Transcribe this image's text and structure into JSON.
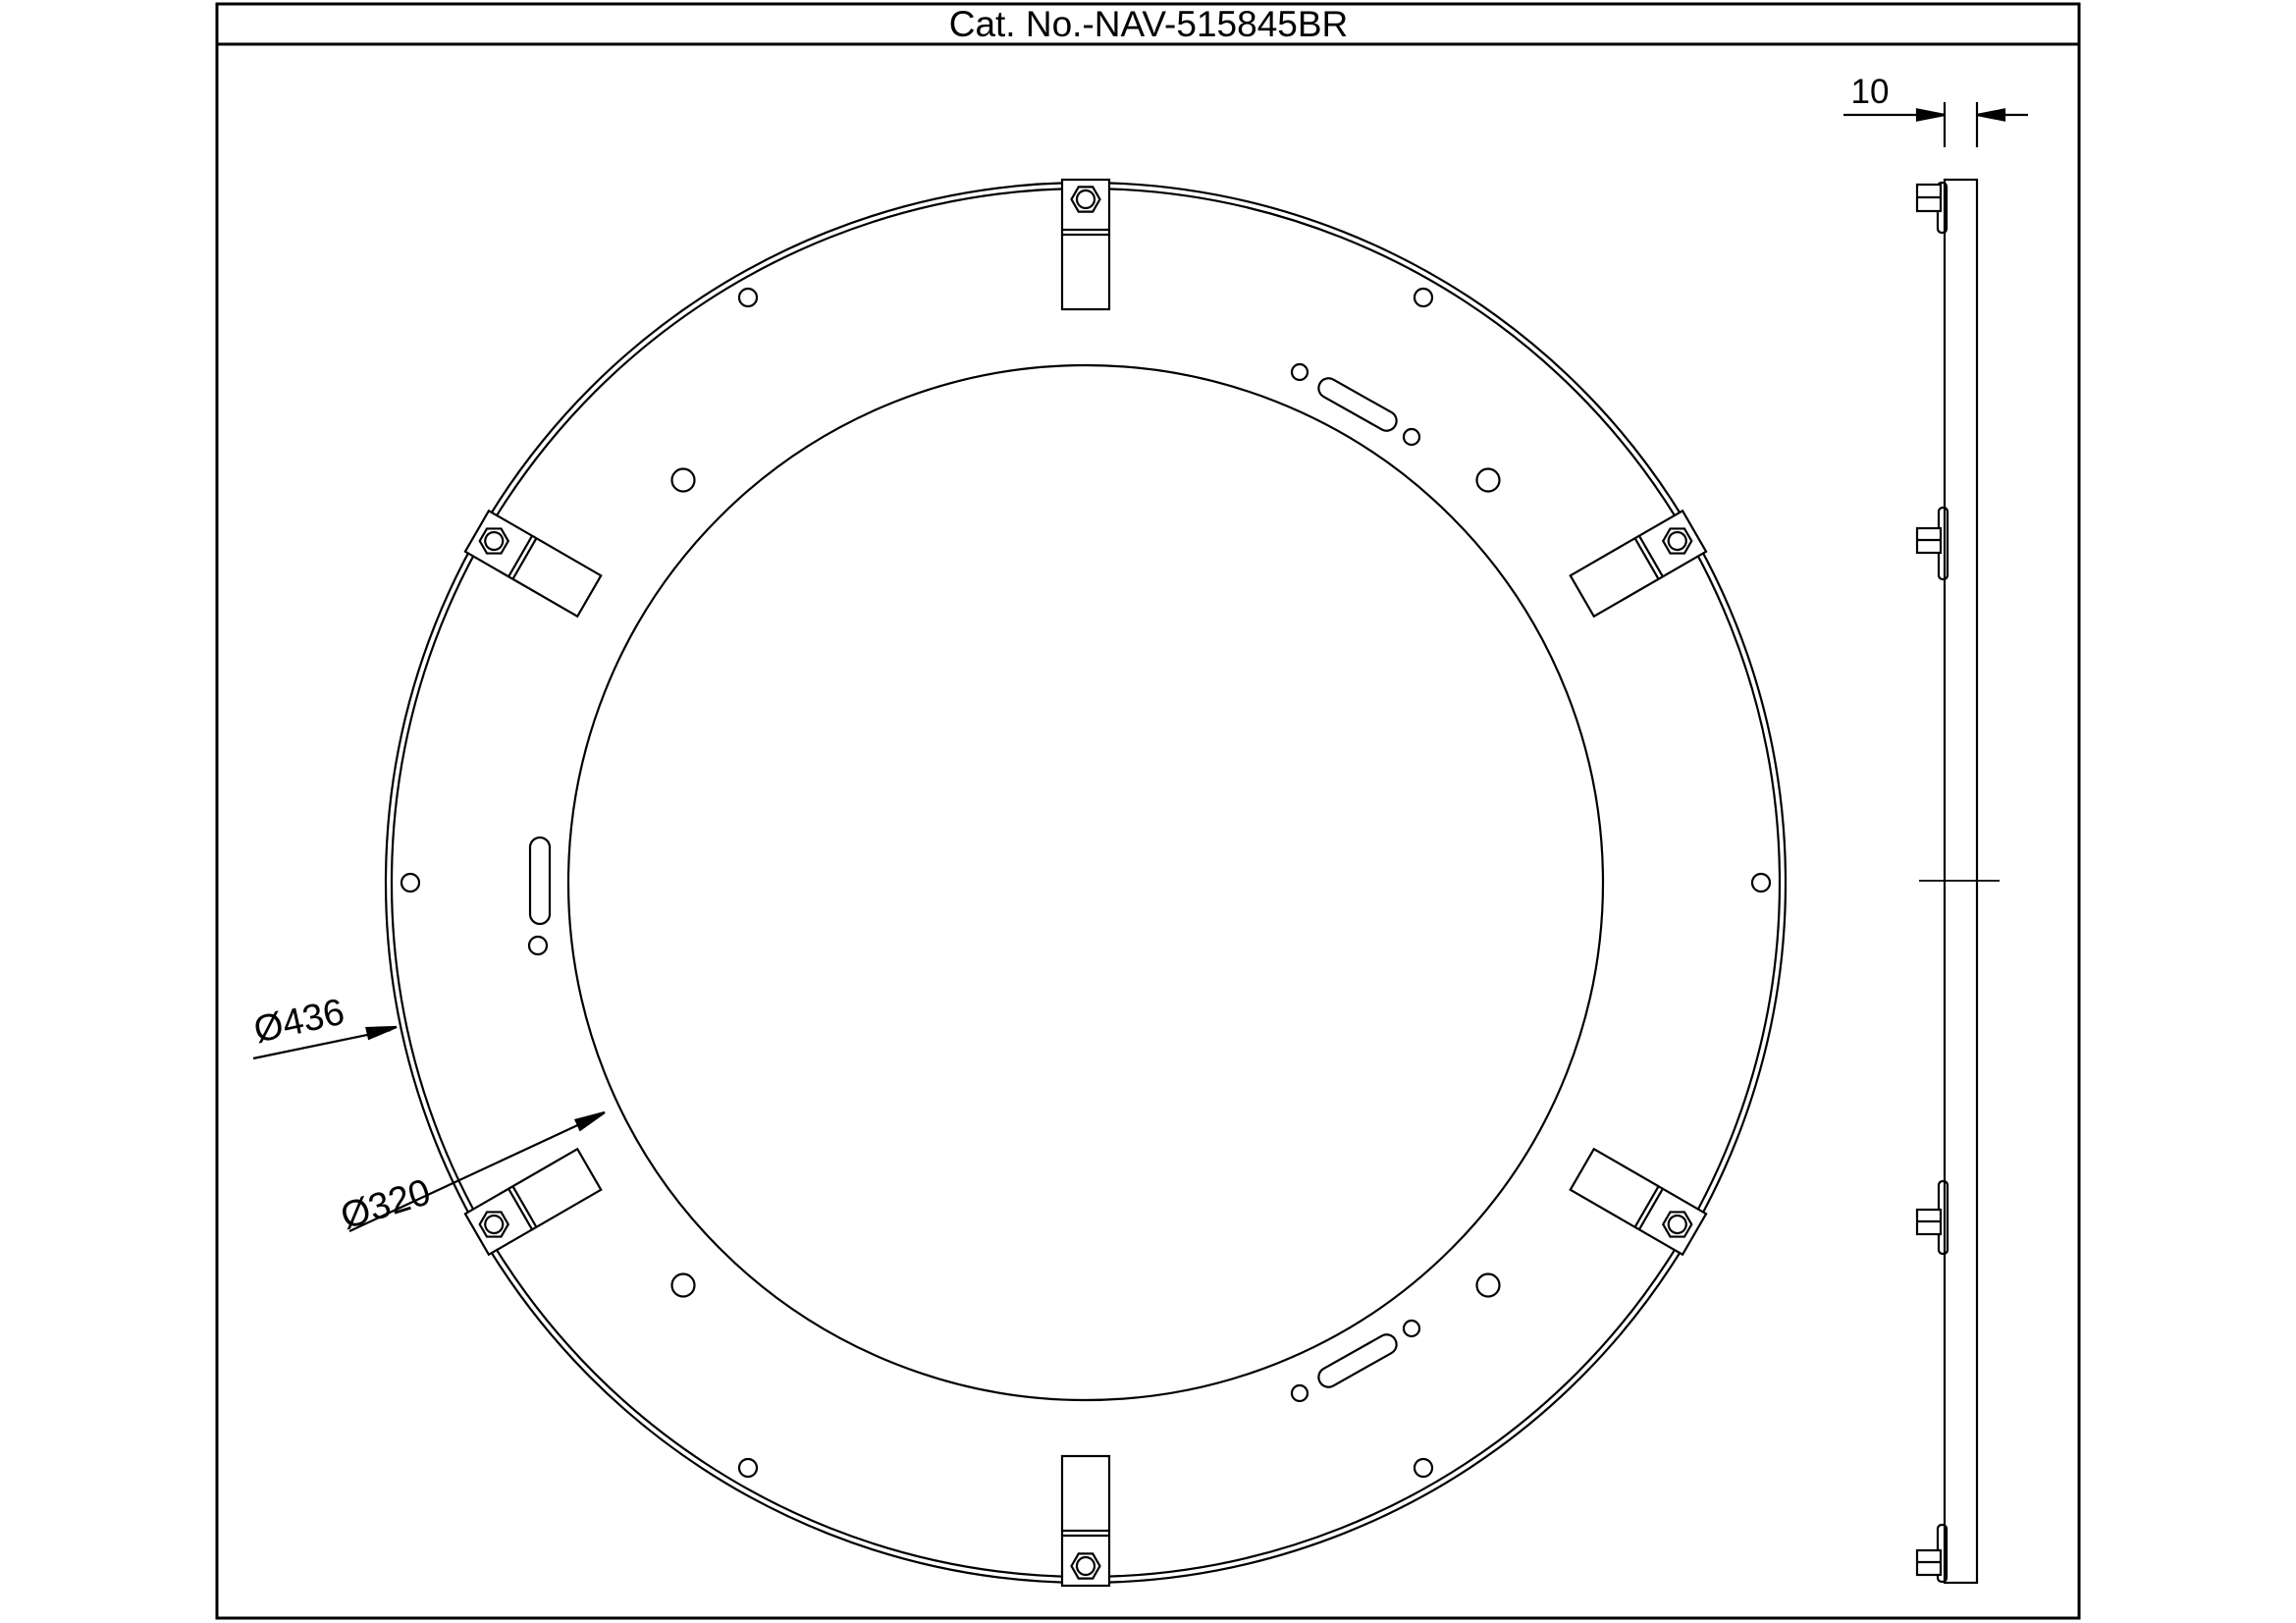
{
  "title_block": {
    "catalog_label": "Cat. No.-NAV-515845BR"
  },
  "front_view": {
    "outer_diameter_label": "Ø436",
    "inner_diameter_label": "Ø320",
    "outer_diameter_value": 436,
    "inner_diameter_value": 320,
    "mounting_tab_count": 6,
    "mounting_tab_angles_deg": [
      30,
      90,
      150,
      210,
      270,
      330
    ],
    "outer_hole_angles_deg": [
      0,
      60,
      120,
      180,
      240,
      300
    ],
    "mid_hole_angles_deg": [
      45,
      135,
      225,
      315
    ],
    "slot_count": 3
  },
  "side_view": {
    "thickness_label": "10",
    "thickness_value": 10
  },
  "colors": {
    "line": "#000000",
    "background": "#ffffff"
  }
}
